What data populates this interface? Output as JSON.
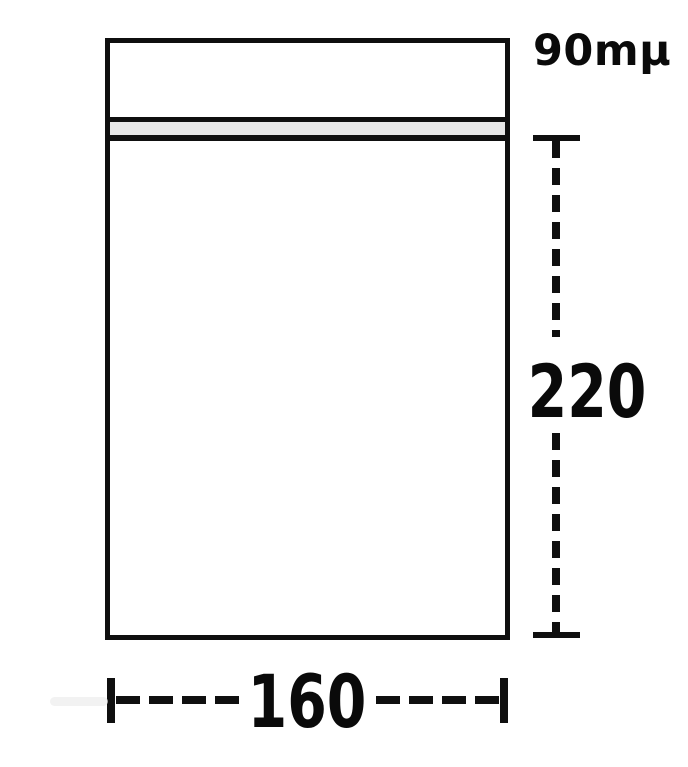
{
  "diagram": {
    "labels": {
      "thickness": "90mμ",
      "height": "220",
      "width": "160"
    }
  },
  "colors": {
    "line": "#0f0f0f",
    "zipper-fill": "#e7e7e7",
    "background": "#ffffff",
    "text": "#0a0a0a"
  }
}
